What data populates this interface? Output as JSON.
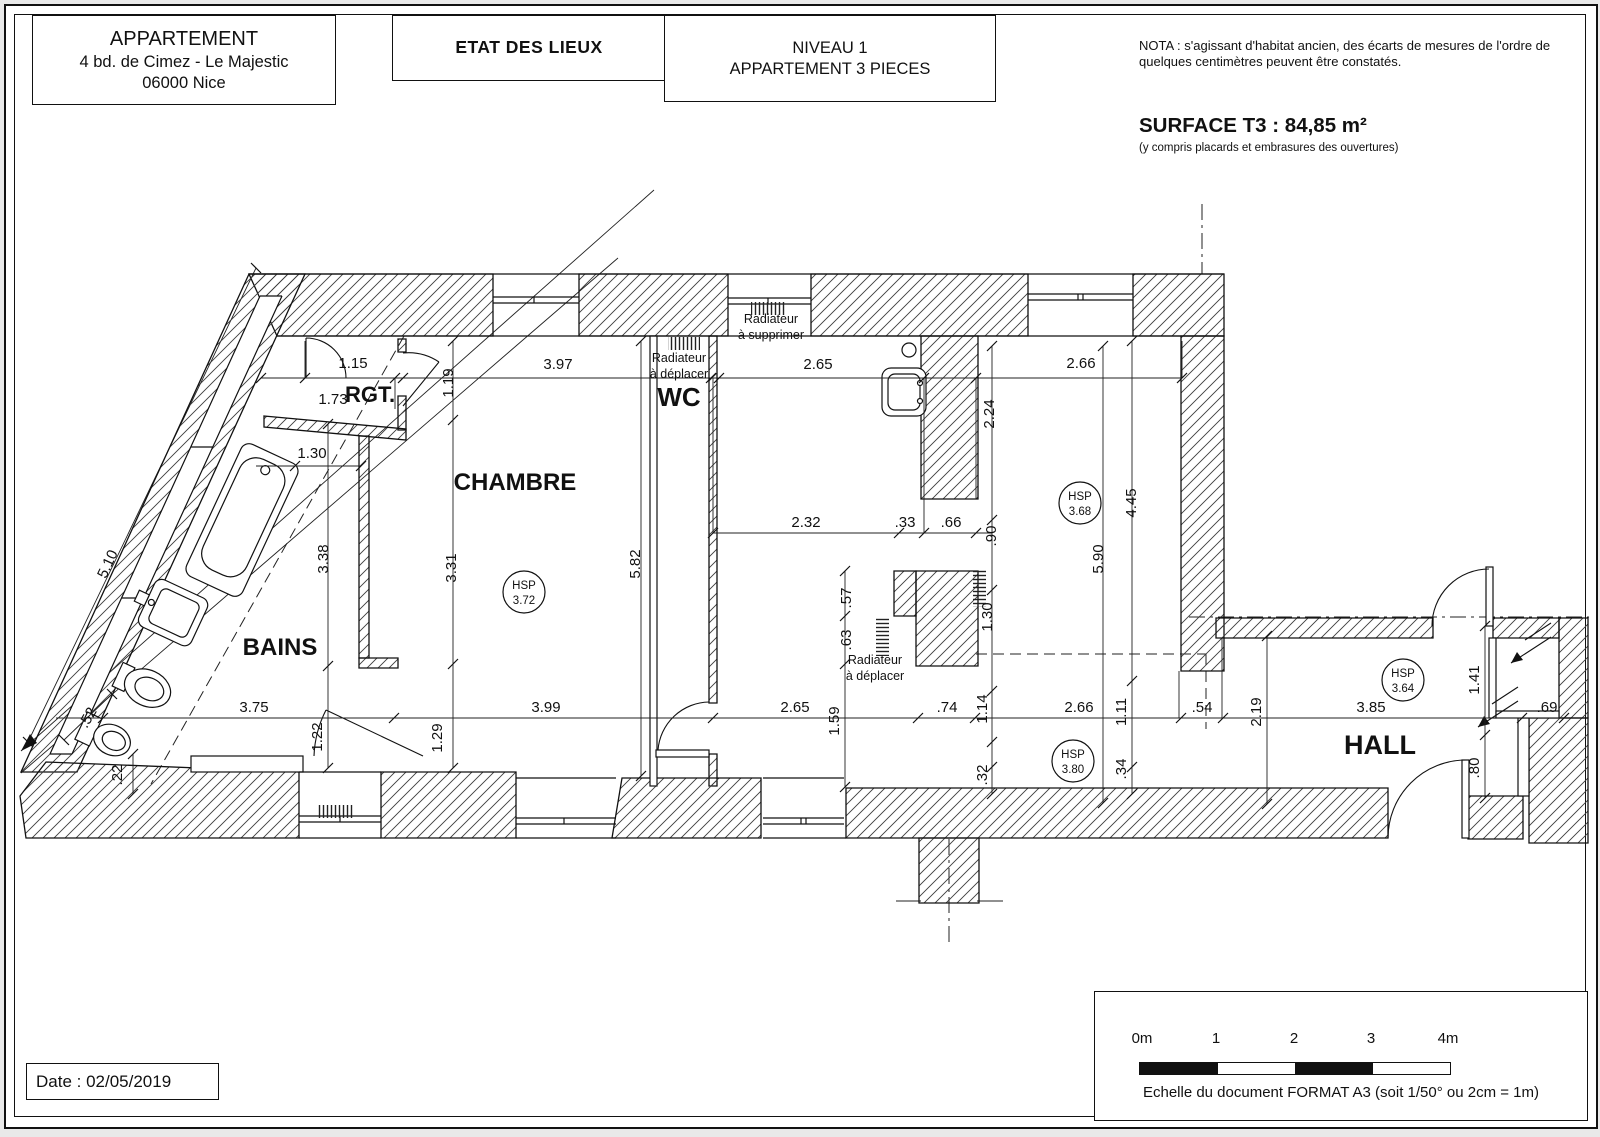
{
  "header": {
    "block1": {
      "line1": "APPARTEMENT",
      "line2": "4 bd. de Cimez - Le Majestic",
      "line3": "06000 Nice"
    },
    "block2": {
      "title": "ETAT DES LIEUX"
    },
    "block3": {
      "line1": "NIVEAU 1",
      "line2": "APPARTEMENT 3 PIECES"
    },
    "nota": "NOTA : s'agissant d'habitat ancien, des écarts de mesures de l'ordre de quelques centimètres peuvent être constatés.",
    "surface_title": "SURFACE T3 : 84,85 m²",
    "surface_sub": "(y compris placards et embrasures des ouvertures)"
  },
  "plan": {
    "hsp_label": "HSP",
    "rooms": [
      {
        "t": "RGT.",
        "x": 364,
        "y": 396,
        "s": 22
      },
      {
        "t": "CHAMBRE",
        "x": 509,
        "y": 484,
        "s": 24
      },
      {
        "t": "WC",
        "x": 673,
        "y": 400,
        "s": 26
      },
      {
        "t": "BAINS",
        "x": 274,
        "y": 649,
        "s": 24
      },
      {
        "t": "HALL",
        "x": 1374,
        "y": 748,
        "s": 27
      }
    ],
    "hsp": [
      {
        "v": "3.72",
        "x": 518,
        "y": 586
      },
      {
        "v": "3.68",
        "x": 1074,
        "y": 497
      },
      {
        "v": "3.80",
        "x": 1067,
        "y": 755
      },
      {
        "v": "3.64",
        "x": 1397,
        "y": 674
      }
    ],
    "notes": [
      {
        "l1": "Radiateur",
        "l2": "à supprimer",
        "x": 765,
        "y": 317
      },
      {
        "l1": "Radiateur",
        "l2": "à déplacer",
        "x": 673,
        "y": 356
      },
      {
        "l1": "Radiateur",
        "l2": "à déplacer",
        "x": 869,
        "y": 658
      }
    ],
    "dims": [
      {
        "t": "1.15",
        "x": 347,
        "y": 362,
        "r": 0
      },
      {
        "t": "1.73",
        "x": 327,
        "y": 398,
        "r": 0
      },
      {
        "t": "1.19",
        "x": 447,
        "y": 377,
        "r": -90
      },
      {
        "t": "3.97",
        "x": 552,
        "y": 363,
        "r": 0
      },
      {
        "t": "2.65",
        "x": 812,
        "y": 363,
        "r": 0
      },
      {
        "t": "2.66",
        "x": 1075,
        "y": 362,
        "r": 0
      },
      {
        "t": "2.24",
        "x": 988,
        "y": 408,
        "r": -90
      },
      {
        "t": "1.30",
        "x": 306,
        "y": 452,
        "r": 0
      },
      {
        "t": "3.38",
        "x": 322,
        "y": 553,
        "r": -90
      },
      {
        "t": "3.31",
        "x": 450,
        "y": 562,
        "r": -90
      },
      {
        "t": "5.82",
        "x": 634,
        "y": 558,
        "r": -90
      },
      {
        "t": "5.10",
        "x": 106,
        "y": 560,
        "r": -65
      },
      {
        "t": "4.45",
        "x": 1130,
        "y": 497,
        "r": -90
      },
      {
        "t": "5.90",
        "x": 1097,
        "y": 553,
        "r": -90
      },
      {
        "t": "2.32",
        "x": 800,
        "y": 521,
        "r": 0
      },
      {
        "t": ".33",
        "x": 899,
        "y": 521,
        "r": 0
      },
      {
        "t": ".66",
        "x": 945,
        "y": 521,
        "r": 0
      },
      {
        "t": ".90",
        "x": 990,
        "y": 530,
        "r": -90
      },
      {
        "t": ".57",
        "x": 845,
        "y": 592,
        "r": -90
      },
      {
        "t": ".63",
        "x": 845,
        "y": 634,
        "r": -90
      },
      {
        "t": "1.30",
        "x": 986,
        "y": 611,
        "r": -90
      },
      {
        "t": "3.75",
        "x": 248,
        "y": 706,
        "r": 0
      },
      {
        "t": "1.22",
        "x": 316,
        "y": 731,
        "r": -90
      },
      {
        "t": "1.29",
        "x": 436,
        "y": 732,
        "r": -90
      },
      {
        "t": "3.99",
        "x": 540,
        "y": 706,
        "r": 0
      },
      {
        "t": "2.65",
        "x": 789,
        "y": 706,
        "r": 0
      },
      {
        "t": "1.59",
        "x": 833,
        "y": 715,
        "r": -90
      },
      {
        "t": ".74",
        "x": 941,
        "y": 706,
        "r": 0
      },
      {
        "t": "1.14",
        "x": 981,
        "y": 703,
        "r": -90
      },
      {
        "t": "2.66",
        "x": 1073,
        "y": 706,
        "r": 0
      },
      {
        "t": "1.11",
        "x": 1120,
        "y": 706,
        "r": -90
      },
      {
        "t": ".54",
        "x": 1196,
        "y": 706,
        "r": 0
      },
      {
        "t": ".32",
        "x": 981,
        "y": 769,
        "r": -90
      },
      {
        "t": ".34",
        "x": 1120,
        "y": 763,
        "r": -90
      },
      {
        "t": "2.19",
        "x": 1255,
        "y": 706,
        "r": -90
      },
      {
        "t": "3.85",
        "x": 1365,
        "y": 706,
        "r": 0
      },
      {
        "t": "1.41",
        "x": 1473,
        "y": 674,
        "r": -90
      },
      {
        "t": ".69",
        "x": 1541,
        "y": 706,
        "r": 0
      },
      {
        "t": ".80",
        "x": 1473,
        "y": 762,
        "r": -90
      },
      {
        "t": ".52",
        "x": 86,
        "y": 714,
        "r": -60
      },
      {
        "t": ".22",
        "x": 116,
        "y": 769,
        "r": -90
      }
    ]
  },
  "footer": {
    "date": "Date : 02/05/2019",
    "scale_labels": [
      "0m",
      "1",
      "2",
      "3",
      "4m"
    ],
    "scale_caption": "Echelle du document FORMAT A3 (soit 1/50° ou 2cm = 1m)"
  }
}
